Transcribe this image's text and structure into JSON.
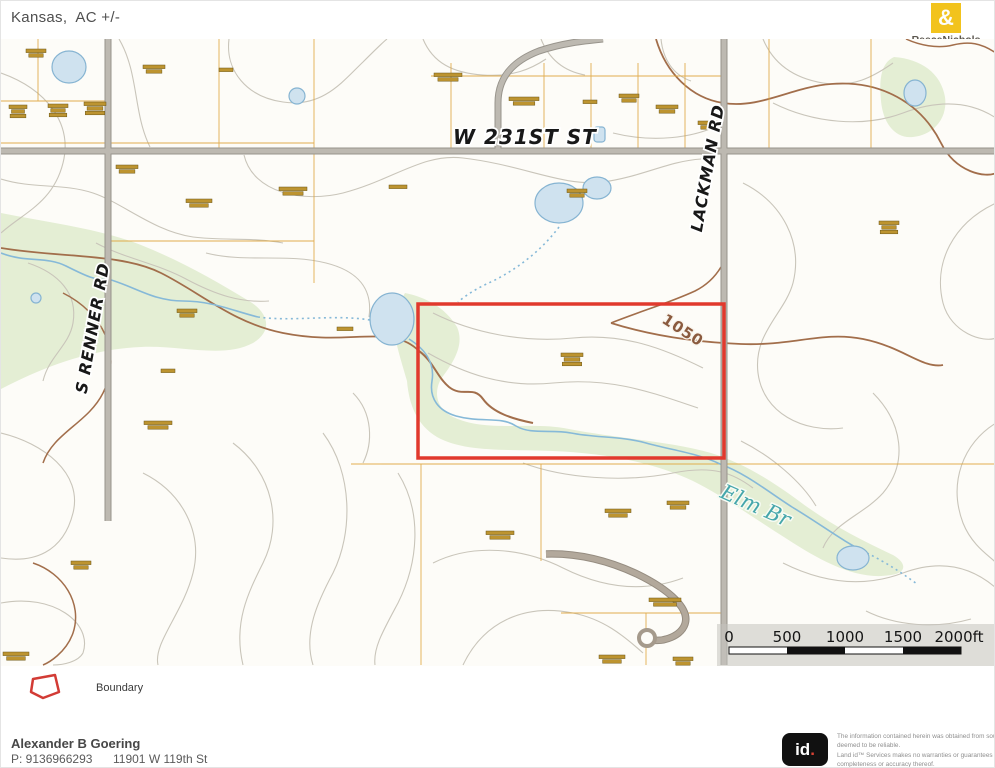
{
  "header": {
    "title": "Kansas,  AC +/-"
  },
  "brand": {
    "name": "ReeceNichols",
    "tagline": "REAL ESTATE",
    "symbol": "&"
  },
  "map": {
    "roads": [
      {
        "name": "W 231ST ST"
      },
      {
        "name": "LACKMAN RD"
      },
      {
        "name": "S RENNER RD"
      }
    ],
    "stream_label": "Elm Br",
    "contour_elevation": "1050",
    "boundary_color": "#e1392d",
    "scale_ticks": [
      "0",
      "500",
      "1000",
      "1500",
      "2000ft"
    ],
    "parcel_markers": [
      [
        25,
        48,
        2,
        20
      ],
      [
        142,
        64,
        2,
        22
      ],
      [
        218,
        67,
        1,
        14
      ],
      [
        8,
        104,
        3,
        18
      ],
      [
        47,
        103,
        3,
        20
      ],
      [
        83,
        101,
        3,
        22
      ],
      [
        433,
        72,
        2,
        28
      ],
      [
        508,
        96,
        2,
        30
      ],
      [
        582,
        99,
        1,
        14
      ],
      [
        618,
        93,
        2,
        20
      ],
      [
        655,
        104,
        2,
        22
      ],
      [
        697,
        120,
        2,
        20
      ],
      [
        566,
        188,
        2,
        20
      ],
      [
        115,
        164,
        2,
        22
      ],
      [
        185,
        198,
        2,
        26
      ],
      [
        278,
        186,
        2,
        28
      ],
      [
        388,
        184,
        1,
        18
      ],
      [
        878,
        220,
        3,
        20
      ],
      [
        176,
        308,
        2,
        20
      ],
      [
        336,
        326,
        1,
        16
      ],
      [
        160,
        368,
        1,
        14
      ],
      [
        143,
        420,
        2,
        28
      ],
      [
        70,
        560,
        2,
        20
      ],
      [
        560,
        352,
        3,
        22
      ],
      [
        666,
        500,
        2,
        22
      ],
      [
        604,
        508,
        2,
        26
      ],
      [
        485,
        530,
        2,
        28
      ],
      [
        648,
        597,
        2,
        32
      ],
      [
        598,
        654,
        2,
        26
      ],
      [
        2,
        651,
        2,
        26
      ],
      [
        672,
        656,
        2,
        20
      ]
    ]
  },
  "legend": {
    "boundary_label": "Boundary"
  },
  "footer": {
    "agent_name": "Alexander B Goering",
    "phone": "P: 9136966293",
    "address": "11901 W 119th St",
    "logo_main": "id",
    "logo_dot": ".",
    "disclaimer_lines": [
      "The information contained herein was obtained from sources",
      "deemed to be reliable.",
      " Land id™ Services makes no warranties or guarantees as to the",
      "completeness or accuracy thereof."
    ]
  }
}
